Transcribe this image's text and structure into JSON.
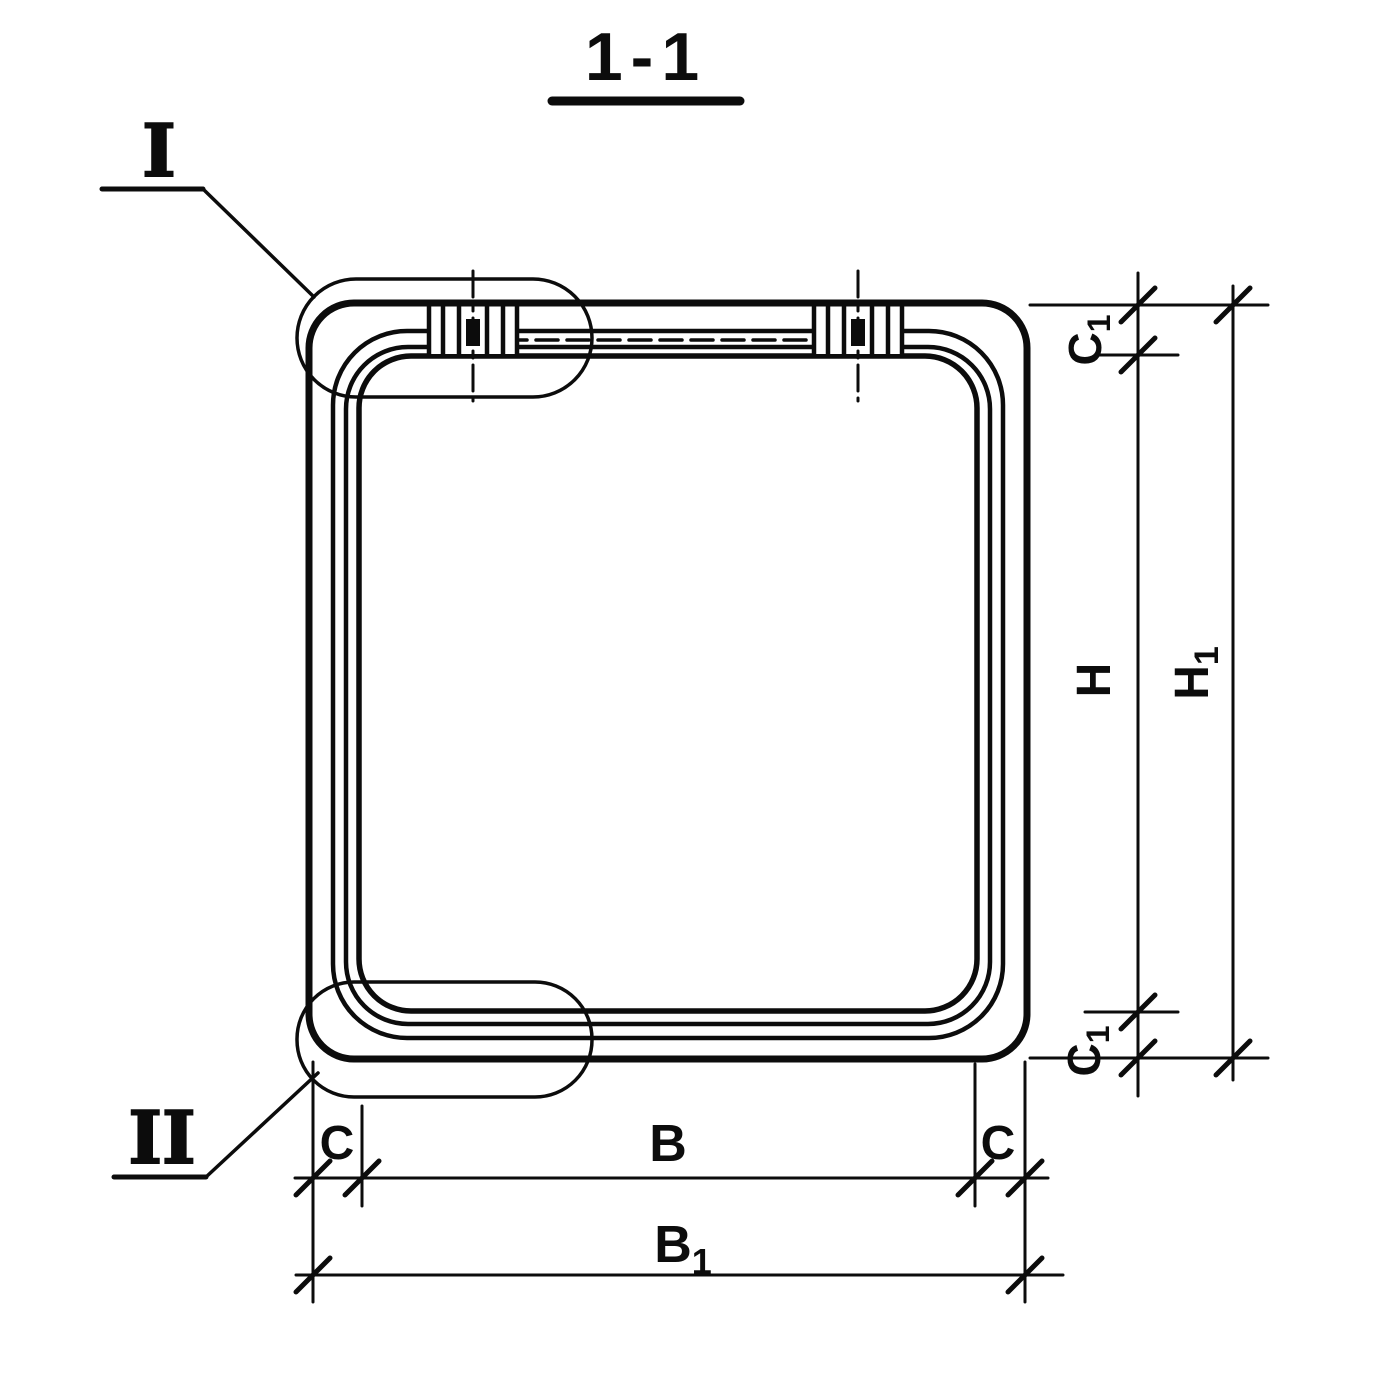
{
  "page": {
    "background": "#ffffff",
    "line_color": "#0c0c0c",
    "kind": "section view technical drawing"
  },
  "section": {
    "title": "1-1"
  },
  "details": {
    "one": {
      "label": "I"
    },
    "two": {
      "label": "II"
    }
  },
  "dims": {
    "c1_top": {
      "base": "C",
      "sub": "1"
    },
    "h": {
      "base": "H",
      "sub": ""
    },
    "h1": {
      "base": "H",
      "sub": "1"
    },
    "c1_bottom": {
      "base": "C",
      "sub": "1"
    },
    "c_left": {
      "base": "C",
      "sub": ""
    },
    "b": {
      "base": "B",
      "sub": ""
    },
    "c_right": {
      "base": "C",
      "sub": ""
    },
    "b1": {
      "base": "B",
      "sub": "1"
    }
  }
}
